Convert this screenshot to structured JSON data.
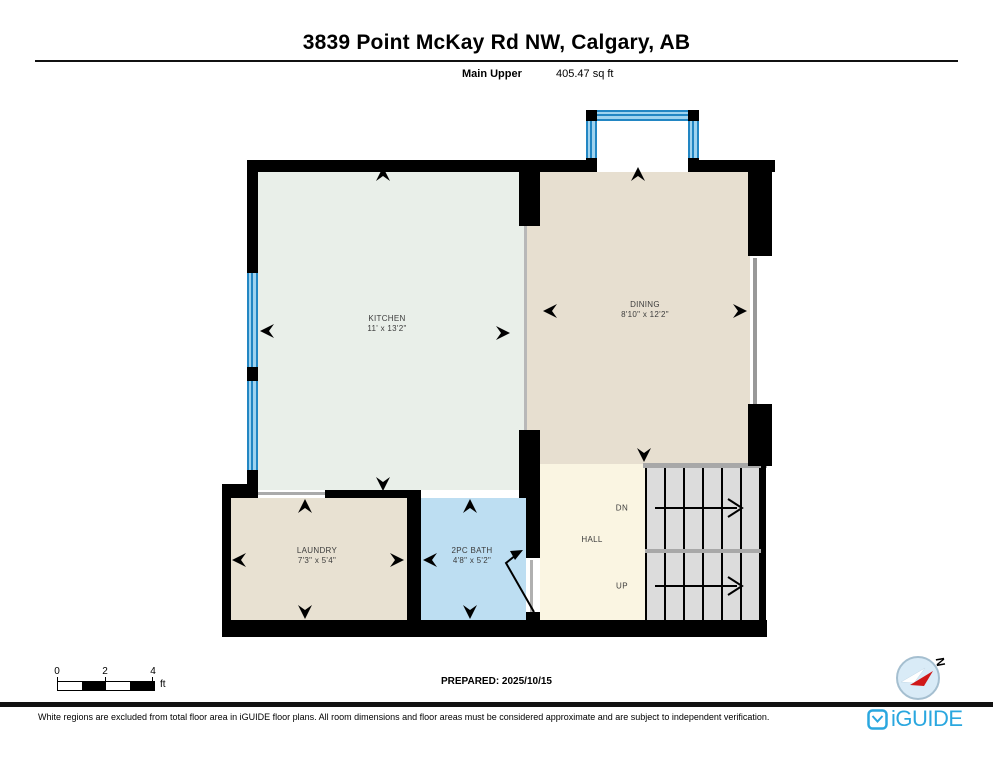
{
  "header": {
    "address": "3839 Point McKay Rd NW, Calgary, AB",
    "floor_name": "Main Upper",
    "floor_area": "405.47 sq ft"
  },
  "rooms": {
    "kitchen": {
      "name": "KITCHEN",
      "dims": "11' x 13'2\""
    },
    "dining": {
      "name": "DINING",
      "dims": "8'10\" x 12'2\""
    },
    "laundry": {
      "name": "LAUNDRY",
      "dims": "7'3\" x 5'4\""
    },
    "bath": {
      "name": "2PC BATH",
      "dims": "4'8\" x 5'2\""
    },
    "hall": {
      "name": "HALL"
    }
  },
  "stairs": {
    "down_label": "DN",
    "up_label": "UP"
  },
  "scale_bar": {
    "tick0": "0",
    "tick2": "2",
    "tick4": "4",
    "unit": "ft"
  },
  "compass": {
    "north_label": "N"
  },
  "footer": {
    "prepared": "PREPARED: 2025/10/15",
    "disclaimer": "White regions are excluded from total floor area in iGUIDE floor plans. All room dimensions and floor areas must be considered approximate and are subject to independent verification.",
    "brand": "iGUIDE"
  },
  "colors": {
    "wall": "#000000",
    "kitchen_floor": "#e9efe9",
    "dining_floor": "#e7dfd0",
    "laundry_floor": "#e8e1d2",
    "bath_floor": "#bddef2",
    "hall_floor": "#faf5e2",
    "window_blue": "#2286c3",
    "stair_fill": "#dcdcdc",
    "brand_blue": "#2aa7df",
    "compass_red": "#d01818"
  }
}
